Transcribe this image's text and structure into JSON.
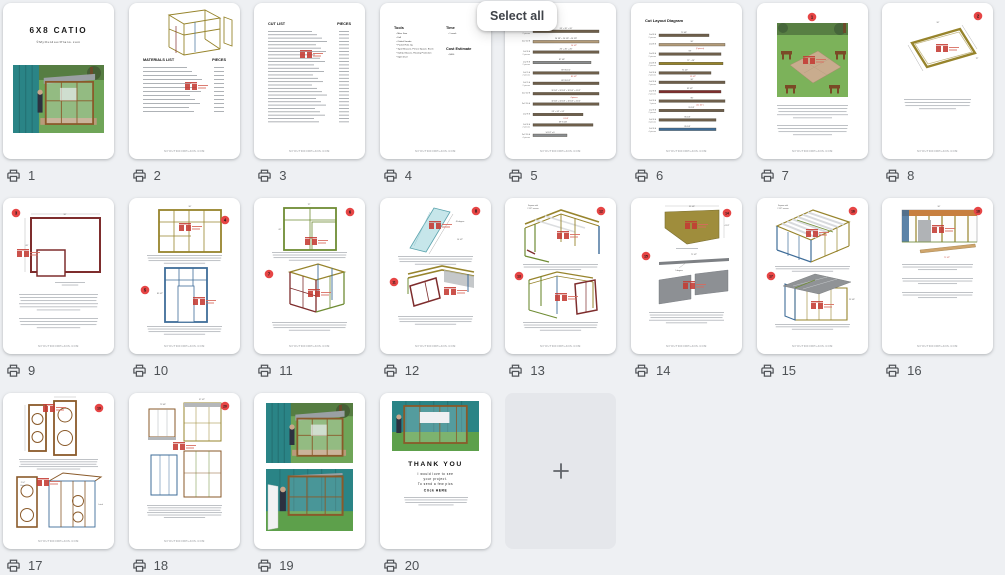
{
  "select_all_label": "Select all",
  "footer_text": "MYOUTDOORPLANS.COM",
  "colors": {
    "teal": "#2a8486",
    "grass": "#64a24e",
    "brown": "#8a5a2a",
    "olive": "#97842c",
    "blue": "#3f6d99",
    "green": "#6f8c34",
    "darkred": "#7e2d2d",
    "cyan": "#c6e6ea",
    "gray": "#8d9094",
    "orange": "#c77f3f",
    "badge": "#e64545",
    "wm": "#c43b33"
  },
  "pages": [
    {
      "number": "1",
      "kind": "cover",
      "title": "6X8 CATIO",
      "subtitle": "©MyOutdoorPlans.com"
    },
    {
      "number": "2",
      "kind": "list",
      "header_left": "MATERIALS LIST",
      "header_right": "PIECES",
      "rows": 12,
      "sketch": "frame3d",
      "header_y": 58,
      "row_start": 64,
      "row_step": 4,
      "wm": [
        62,
        84
      ],
      "footer": true
    },
    {
      "number": "3",
      "kind": "list",
      "header_left": "CUT LIST",
      "header_right": "PIECES",
      "rows": 28,
      "header_y": 22,
      "row_start": 28,
      "row_step": 3.35,
      "wm": [
        52,
        52
      ],
      "footer": true
    },
    {
      "number": "4",
      "kind": "tools",
      "sections": [
        {
          "title": "Tools",
          "items": [
            "Miter Saw",
            "Drill",
            "Orbital Sander",
            "Pocket Hole Jig",
            "Tape Measure, Pencil, Square, Brush",
            "Safety Glasses, Hearing Protection",
            "Spirit level"
          ]
        },
        {
          "title": "Time",
          "items": [
            "1 week"
          ]
        },
        {
          "title": "Cost Estimate",
          "items": [
            "$400"
          ]
        }
      ],
      "footer": true
    },
    {
      "number": "5",
      "kind": "cutlayout",
      "title": "Cut Layout Diagram",
      "title_y": 15,
      "row_start": 26,
      "row_step": 10.4,
      "footer": true,
      "rows": [
        {
          "l1": "2x2 8 ft",
          "l2": "2 pieces",
          "dim": "26\" + 26\" + 26\"",
          "c": "#6e5f4b",
          "w": 66
        },
        {
          "l1": "2x2 10 ft",
          "dim": "26 7/8\" + 26 7/8\" + 26 7/8\"",
          "red": "14 1/2\"",
          "c": "#b39b79",
          "w": 66
        },
        {
          "l1": "2x2 8 ft",
          "l2": "2 pieces",
          "dim": "26\" + 26\" + 26\"",
          "c": "#6e5f4b",
          "w": 66
        },
        {
          "l1": "2x2 8 ft",
          "l2": "2 pieces",
          "dim": "87 1/4\"",
          "c": "#8a8d90",
          "w": 58
        },
        {
          "l1": "2x2 9 ft",
          "l2": "2 pieces",
          "dim": "69\"   85 1/2\"",
          "red": "85 1/2\"",
          "c": "#6e5f4b",
          "w": 66
        },
        {
          "l1": "2x2 9 ft",
          "l2": "2 pieces",
          "dim": "69\"   85 1/2\"",
          "c": "#6e5f4b",
          "w": 66
        },
        {
          "l1": "2x2 10 ft",
          "dim": "32 1/4\" + 32 1/4\" + 32 1/4\" + 4 1/2\"",
          "red": "4 pieces",
          "c": "#6e5f4b",
          "w": 66
        },
        {
          "l1": "2x2 10 ft",
          "dim": "32 1/4\" + 32 1/4\" + 32 1/4\" + 4 1/2\"",
          "c": "#6e5f4b",
          "w": 66
        },
        {
          "l1": "2x2 8 ft",
          "dim": "24\" + 24\" + 24\"",
          "red": "8 1/4\"",
          "c": "#6e5f4b",
          "w": 50
        },
        {
          "l1": "2x2 8 ft",
          "l2": "2 pieces",
          "dim": "69\"   8 1/4\"",
          "c": "#6e5f4b",
          "w": 60
        },
        {
          "l1": "2x2 10 ft",
          "l2": "4 pieces",
          "dim": "14 1/2\" x 8",
          "c": "#8a8d90",
          "w": 34
        }
      ]
    },
    {
      "number": "6",
      "kind": "cutlayout",
      "title": "Cut Layout Diagram",
      "title_y": 19,
      "row_start": 30,
      "row_step": 9.4,
      "footer": true,
      "rows": [
        {
          "l1": "2x4 8 ft",
          "l2": "2 pieces",
          "dim": "71 3/4\"",
          "c": "#6e5f4b",
          "w": 50
        },
        {
          "l1": "2x4 8 ft",
          "dim": "96\"",
          "red": "(2 pieces)",
          "c": "#b39b79",
          "w": 66
        },
        {
          "l1": "2x4 8 ft",
          "l2": "2 pieces",
          "dim": "93\"",
          "c": "#6e5f4b",
          "w": 62
        },
        {
          "l1": "2x4 8 ft",
          "l2": "2 pieces",
          "dim": "71\" + 24\"",
          "c": "#97842c",
          "w": 64
        },
        {
          "l1": "2x2 8 ft",
          "l2": "2 pieces",
          "dim": "71 1/2\"",
          "red": "19 1/2\"",
          "c": "#6e5f4b",
          "w": 52
        },
        {
          "l1": "2x2 8 ft",
          "l2": "7 pieces",
          "dim": "96\"",
          "c": "#6e5f4b",
          "w": 66
        },
        {
          "l1": "2x2 8 ft",
          "l2": "2 pieces",
          "dim": "92 1/2\"",
          "c": "#7e2d2d",
          "w": 62
        },
        {
          "l1": "2x2 8 ft",
          "l2": "1 piece",
          "dim": "96\"",
          "red": "(2x 1/2\")",
          "c": "#6e5f4b",
          "w": 66
        },
        {
          "l1": "2x2 8 ft",
          "l2": "2 pieces",
          "dim": "95 1/4\"",
          "c": "#6e5f4b",
          "w": 65
        },
        {
          "l1": "2x2 8 ft",
          "l2": "4 pieces",
          "dim": "85 1/4\"",
          "c": "#6e5f4b",
          "w": 57
        },
        {
          "l1": "2x2 8 ft",
          "l2": "4 pieces",
          "dim": "85 1/4\"",
          "c": "#3f6d99",
          "w": 57
        }
      ]
    },
    {
      "number": "7",
      "kind": "steps",
      "badges": [
        {
          "x": 55,
          "y": 14,
          "t": "1"
        }
      ],
      "sketches": [
        "site"
      ],
      "texts": [
        {
          "x": 20,
          "y": 102,
          "w": 71,
          "n": 5
        },
        {
          "x": 20,
          "y": 122,
          "w": 71,
          "n": 4
        }
      ],
      "footer": true
    },
    {
      "number": "8",
      "kind": "steps",
      "badges": [
        {
          "x": 96,
          "y": 13,
          "t": "2"
        }
      ],
      "sketches": [
        "persp"
      ],
      "dims": [
        {
          "t": "96\"",
          "x": 56,
          "y": 20
        },
        {
          "t": "72\"",
          "x": 95,
          "y": 56
        }
      ],
      "texts": [
        {
          "x": 22,
          "y": 96,
          "w": 67,
          "n": 4
        }
      ],
      "footer": true
    },
    {
      "number": "9",
      "kind": "steps",
      "badges": [
        {
          "x": 13,
          "y": 15,
          "t": "3"
        }
      ],
      "sketches": [
        "backwall"
      ],
      "dims": [
        {
          "t": "96\"",
          "x": 62,
          "y": 17
        },
        {
          "t": "69\"",
          "x": 24,
          "y": 48
        }
      ],
      "texts": [
        {
          "x": 16,
          "y": 96,
          "w": 79,
          "n": 6
        },
        {
          "x": 16,
          "y": 120,
          "w": 79,
          "n": 4
        }
      ],
      "footer": true
    },
    {
      "number": "10",
      "kind": "steps",
      "badges": [
        {
          "x": 96,
          "y": 22,
          "t": "4"
        },
        {
          "x": 16,
          "y": 92,
          "t": "5"
        }
      ],
      "sketches": [
        "olivewall",
        "bluewall"
      ],
      "dims": [
        {
          "t": "96\"",
          "x": 61,
          "y": 9
        },
        {
          "t": "85 1/2\"",
          "x": 31,
          "y": 96
        }
      ],
      "texts": [
        {
          "x": 18,
          "y": 57,
          "w": 75,
          "n": 4,
          "gap": 2.6
        },
        {
          "x": 18,
          "y": 128,
          "w": 75,
          "n": 4,
          "gap": 2.6
        }
      ],
      "footer": true
    },
    {
      "number": "11",
      "kind": "steps",
      "badges": [
        {
          "x": 96,
          "y": 14,
          "t": "6"
        },
        {
          "x": 15,
          "y": 76,
          "t": "7"
        }
      ],
      "sketches": [
        "greenwall",
        "box3d"
      ],
      "dims": [
        {
          "t": "72\"",
          "x": 55,
          "y": 7
        },
        {
          "t": "69\"",
          "x": 26,
          "y": 32
        }
      ],
      "texts": [
        {
          "x": 18,
          "y": 54,
          "w": 75,
          "n": 4,
          "gap": 2.6
        },
        {
          "x": 18,
          "y": 124,
          "w": 75,
          "n": 4,
          "gap": 2.6
        }
      ],
      "footer": true
    },
    {
      "number": "12",
      "kind": "steps",
      "badges": [
        {
          "x": 96,
          "y": 13,
          "t": "8"
        },
        {
          "x": 14,
          "y": 84,
          "t": "11"
        }
      ],
      "sketches": [
        "diagboard",
        "roofasm"
      ],
      "dims": [
        {
          "t": "45-degree",
          "x": 80,
          "y": 24
        },
        {
          "t": "14 1/2\"",
          "x": 80,
          "y": 42
        }
      ],
      "texts": [
        {
          "x": 18,
          "y": 58,
          "w": 75,
          "n": 4,
          "gap": 2.6
        },
        {
          "x": 18,
          "y": 118,
          "w": 75,
          "n": 4,
          "gap": 2.6
        }
      ],
      "footer": true
    },
    {
      "number": "13",
      "kind": "steps",
      "badges": [
        {
          "x": 96,
          "y": 13,
          "t": "12"
        },
        {
          "x": 14,
          "y": 78,
          "t": "13"
        }
      ],
      "sketches": [
        "walls3d",
        "cagedoor"
      ],
      "dims": [
        {
          "t": "Square with",
          "x": 28,
          "y": 8
        },
        {
          "t": "2 1/2\" screws",
          "x": 28,
          "y": 11
        }
      ],
      "texts": [
        {
          "x": 18,
          "y": 66,
          "w": 75,
          "n": 3,
          "gap": 2.6
        },
        {
          "x": 18,
          "y": 124,
          "w": 75,
          "n": 4,
          "gap": 2.6
        }
      ],
      "footer": true
    },
    {
      "number": "14",
      "kind": "steps",
      "badges": [
        {
          "x": 96,
          "y": 15,
          "t": "14"
        },
        {
          "x": 15,
          "y": 58,
          "t": "15"
        }
      ],
      "sketches": [
        "trap",
        "grayboards"
      ],
      "dims": [
        {
          "t": "55 1/4\"",
          "x": 61,
          "y": 9
        },
        {
          "t": "4 1/2\"",
          "x": 96,
          "y": 28
        },
        {
          "t": "71 1/2\"",
          "x": 63,
          "y": 57
        },
        {
          "t": "5-degree",
          "x": 48,
          "y": 73
        }
      ],
      "texts": [
        {
          "x": 36,
          "y": 50,
          "w": 40,
          "n": 1
        },
        {
          "x": 18,
          "y": 114,
          "w": 75,
          "n": 5,
          "gap": 2.6
        }
      ],
      "footer": true
    },
    {
      "number": "15",
      "kind": "steps",
      "badges": [
        {
          "x": 96,
          "y": 13,
          "t": "16"
        },
        {
          "x": 14,
          "y": 78,
          "t": "17"
        }
      ],
      "sketches": [
        "rafters",
        "roofpanels"
      ],
      "dims": [
        {
          "t": "Square with",
          "x": 26,
          "y": 8
        },
        {
          "t": "2 1/2\" screws",
          "x": 26,
          "y": 11
        },
        {
          "t": "23 1/4\"",
          "x": 95,
          "y": 102
        }
      ],
      "texts": [
        {
          "x": 18,
          "y": 68,
          "w": 75,
          "n": 3,
          "gap": 2.4
        },
        {
          "x": 18,
          "y": 126,
          "w": 75,
          "n": 3,
          "gap": 2.4
        }
      ],
      "footer": true
    },
    {
      "number": "16",
      "kind": "steps",
      "badges": [
        {
          "x": 96,
          "y": 13,
          "t": "18"
        }
      ],
      "sketches": [
        "elevation"
      ],
      "dims": [
        {
          "t": "96\"",
          "x": 57,
          "y": 9
        },
        {
          "t": "71 1/2\"",
          "x": 65,
          "y": 60,
          "c": "#c0392b"
        }
      ],
      "texts": [
        {
          "x": 20,
          "y": 66,
          "w": 71,
          "n": 3,
          "gap": 2.6
        },
        {
          "x": 20,
          "y": 80,
          "w": 71,
          "n": 3,
          "gap": 2.6
        },
        {
          "x": 20,
          "y": 94,
          "w": 71,
          "n": 3,
          "gap": 2.6
        }
      ],
      "footer": true
    },
    {
      "number": "17",
      "kind": "steps",
      "badges": [
        {
          "x": 96,
          "y": 15,
          "t": "19"
        }
      ],
      "sketches": [
        "doors",
        "doorcage"
      ],
      "dims": [
        {
          "t": "Latch",
          "x": 100,
          "y": 112,
          "a": "end"
        },
        {
          "t": "2\"x2\"",
          "x": 20,
          "y": 90
        },
        {
          "t": "Hinge",
          "x": 20,
          "y": 93
        }
      ],
      "texts": [
        {
          "x": 16,
          "y": 66,
          "w": 79,
          "n": 5,
          "gap": 2.4
        }
      ],
      "footer": true
    },
    {
      "number": "18",
      "kind": "steps",
      "badges": [
        {
          "x": 96,
          "y": 13,
          "t": "20"
        }
      ],
      "sketches": [
        "views4"
      ],
      "dims": [
        {
          "t": "72 3/4\"",
          "x": 34,
          "y": 12
        },
        {
          "t": "97 1/2\"",
          "x": 73,
          "y": 7
        }
      ],
      "texts": [
        {
          "x": 18,
          "y": 112,
          "w": 75,
          "n": 6,
          "gap": 2.4
        }
      ],
      "footer": true
    },
    {
      "number": "19",
      "kind": "photos"
    },
    {
      "number": "20",
      "kind": "thankyou",
      "title": "THANK YOU",
      "lines": [
        "I would love to see",
        "your project.",
        "To send a few pics"
      ],
      "cta": "Click HERE"
    },
    {
      "kind": "add"
    }
  ]
}
